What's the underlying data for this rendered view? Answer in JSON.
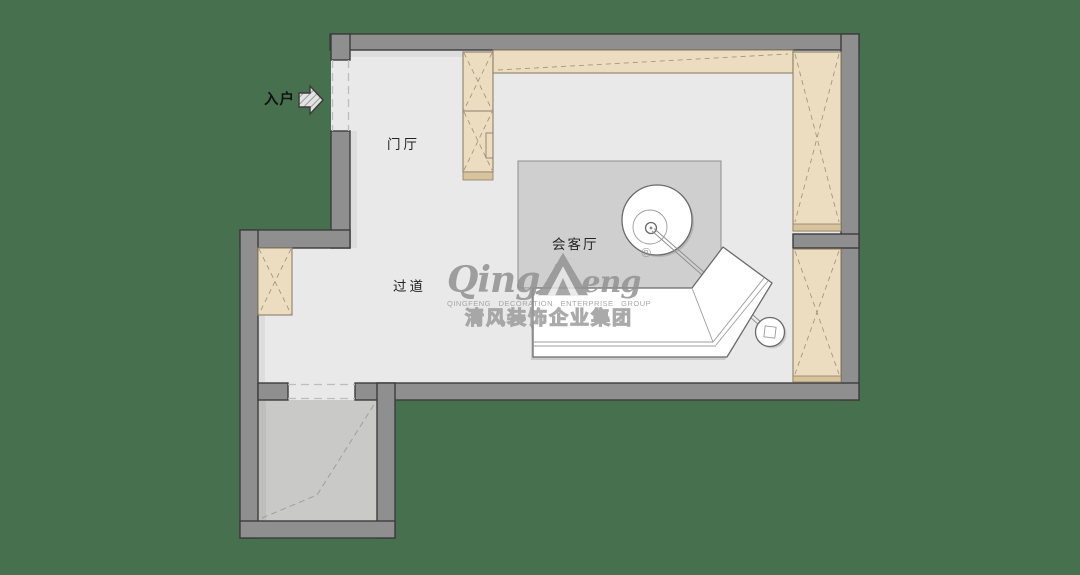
{
  "canvas": {
    "width": 1080,
    "height": 575
  },
  "plan": {
    "labels": {
      "entry": "入户",
      "foyer": "门厅",
      "corridor": "过道",
      "living_room": "会客厅"
    },
    "watermark": {
      "brand_left": "Qing",
      "brand_right": "eng",
      "registered": "®",
      "line_en": "QINGFENG DECORATION ENTERPRISE GROUP",
      "line_cn": "清风装饰企业集团"
    },
    "colors": {
      "background": "#47714e",
      "wall_fill": "#8f8f8f",
      "wall_stroke": "#3c3c3c",
      "floor": "#e9e9e9",
      "floor_dark": "#c9c9c8",
      "rug": "#cfcfcf",
      "cabinet_fill": "#ecddc0",
      "cabinet_stroke": "#8d8069",
      "cabinet_strip": "#d8c49c",
      "line": "#6b6b6b",
      "watermark": "#9a9a9a",
      "label_color": "#242424"
    }
  }
}
